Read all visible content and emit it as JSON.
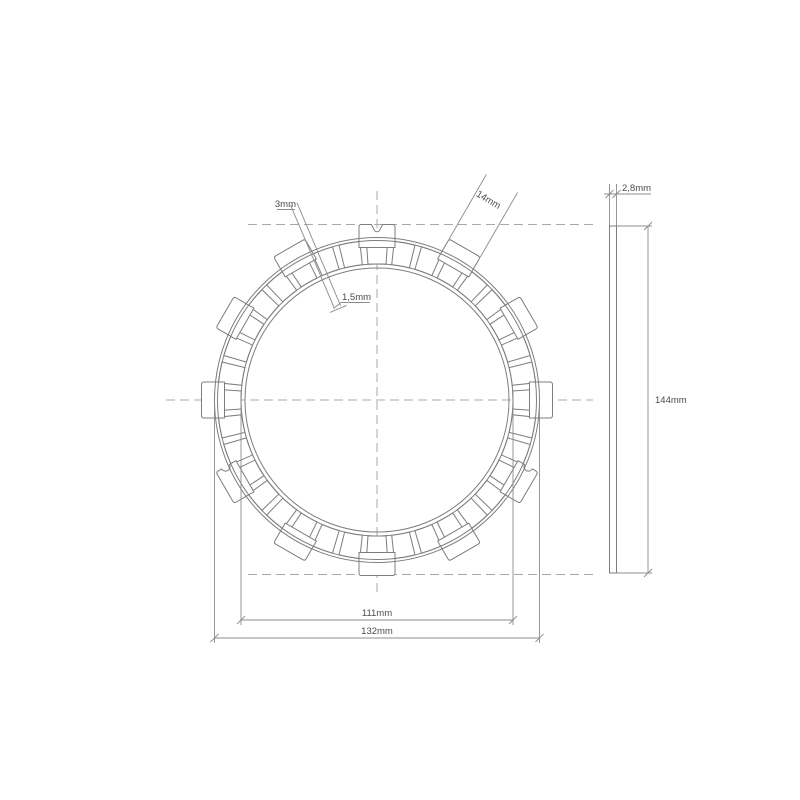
{
  "title": "clutch-friction-plate-technical-drawing",
  "colors": {
    "background": "#ffffff",
    "geometry_line": "#7d7d7d",
    "dimension_line": "#8c8c8c",
    "centerline": "#a8a8a8",
    "text": "#4b4b4b"
  },
  "front_view": {
    "labels": {
      "slot_width_outer": "3mm",
      "slot_width_inner": "1,5mm",
      "tab_width": "14mm",
      "friction_inner_diameter": "111mm",
      "outer_diameter": "132mm"
    },
    "pad_count": 36,
    "tab_count": 12,
    "tab_angle_step_deg": 30,
    "keyway_tab_angle": 90,
    "side_notch_tabs": [
      {
        "angle": 210,
        "notch_edge": "right"
      },
      {
        "angle": 330,
        "notch_edge": "left"
      }
    ]
  },
  "side_view": {
    "labels": {
      "thickness": "2,8mm",
      "overall_height": "144mm"
    }
  }
}
